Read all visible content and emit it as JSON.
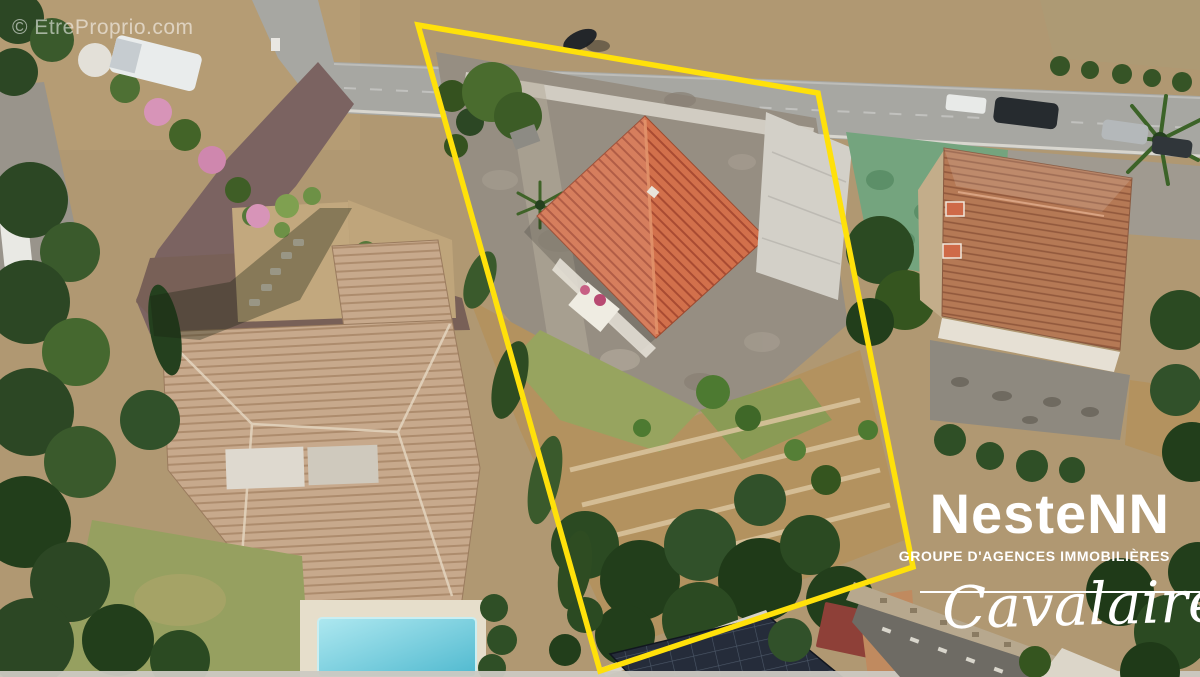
{
  "watermark": {
    "text": "© EtreProprio.com"
  },
  "boundary": {
    "points": "418,25 818,93 913,567 600,671",
    "color": "#FFE10A"
  },
  "branding": {
    "name": "NesteNN",
    "tagline": "GROUPE D'AGENCES IMMOBILIÈRES",
    "location": "Cavalaire",
    "text_color": "#FFFFFF"
  }
}
